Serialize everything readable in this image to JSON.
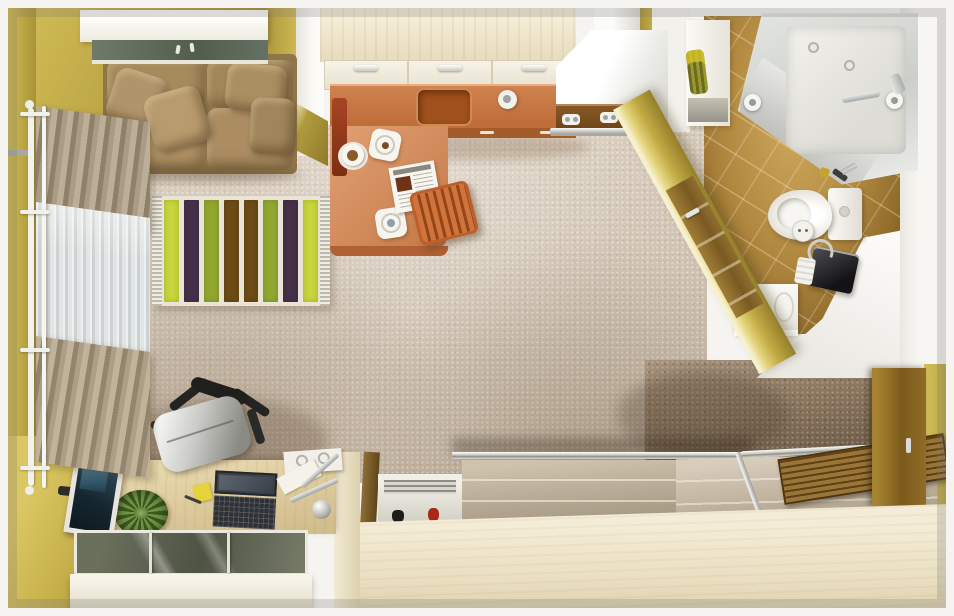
{
  "scene": {
    "type": "3d-top-down-floor-plan-render",
    "subject": "studio apartment with living area, kitchen, bathroom and entry hall",
    "width_px": 954,
    "height_px": 616
  },
  "palette": {
    "wall_olive_light": "#d3bf58",
    "wall_olive_dark": "#947e2c",
    "wall_white": "#f4f3ef",
    "carpet_beige": "#d7cbbc",
    "cream_wood": "#f0e8d2",
    "sofa_tan": "#a98e5e",
    "counter_orange": "#c8763f",
    "table_orange": "#d6966a",
    "sink_orange": "#a0511d",
    "stool_orange": "#c4662c",
    "bath_tile_tan": "#b1883f",
    "shower_glass": "#dfe0dc",
    "chrome": "#cfd2d0",
    "door_wood": "#8a6a2c",
    "hall_floor_brown": "#7c6b56",
    "wardrobe_panel": "#c0b49e",
    "tv_screen_blue": "#2e4a5c",
    "plant_green": "#577033",
    "rug_base_cream": "#eae4d6"
  },
  "rug": {
    "stripes": [
      "#c8d53c",
      "#463049",
      "#92a72f",
      "#6d4b15",
      "#6d4b15",
      "#92a72f",
      "#463049",
      "#c8d53c"
    ]
  },
  "rooms": [
    {
      "name": "living-area",
      "objects": [
        "wall-shelf",
        "sofa",
        "throw-pillows",
        "window-curtains",
        "curtain-rod",
        "striped-rug",
        "wall-tv",
        "desk",
        "laptop",
        "sticky-note",
        "pen",
        "plant",
        "office-chair",
        "desk-lamp",
        "ring-binder",
        "glass-sideboard"
      ]
    },
    {
      "name": "kitchen",
      "objects": [
        "upper-cabinets",
        "range-hood",
        "cooktop",
        "countertop",
        "sink",
        "faucet",
        "breakfast-table",
        "newspaper",
        "plates",
        "coffee-cup",
        "slatted-stool",
        "high-chair"
      ]
    },
    {
      "name": "bathroom",
      "objects": [
        "corner-shower",
        "shower-tray",
        "toilet",
        "vanity-sink",
        "towel-shelf",
        "bathroom-door",
        "toiletry-bag",
        "towels"
      ]
    },
    {
      "name": "hallway",
      "objects": [
        "entry-door",
        "sliding-door-wardrobe",
        "shoe-rack",
        "wooden-entry-mat"
      ]
    }
  ]
}
